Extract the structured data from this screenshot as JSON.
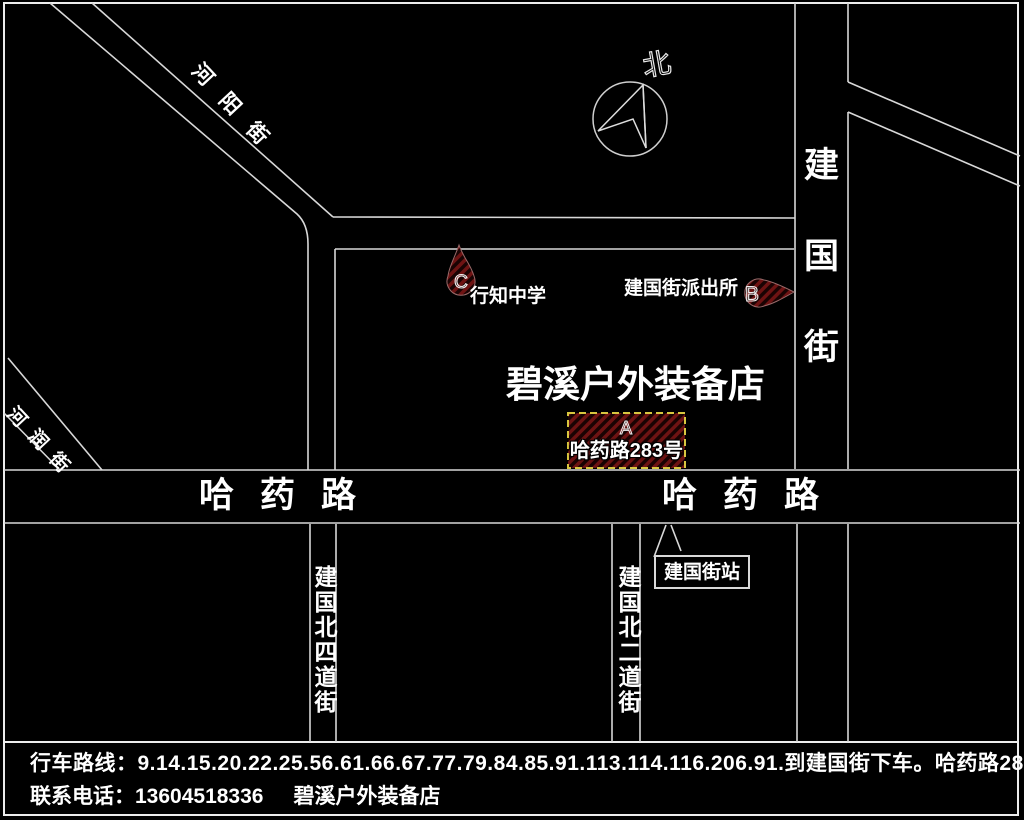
{
  "compass": {
    "north": "北"
  },
  "streets": {
    "heyang": "河阳街",
    "herun": "河润街",
    "jianguo_vertical": "建国街",
    "hayao_west": "哈药路",
    "hayao_east": "哈药路",
    "jianguo_north4": "建国北四道街",
    "jianguo_north2": "建国北二道街"
  },
  "markers": {
    "a": {
      "letter": "A",
      "address": "哈药路283号"
    },
    "b": {
      "letter": "B",
      "label": "建国街派出所"
    },
    "c": {
      "letter": "C",
      "label": "行知中学"
    }
  },
  "store": {
    "name": "碧溪户外装备店"
  },
  "bus_stop": {
    "label": "建国街站"
  },
  "footer": {
    "route": "行车路线：9.14.15.20.22.25.56.61.66.67.77.79.84.85.91.113.114.116.206.91.到建国街下车。哈药路283号。",
    "phone": "联系电话：13604518336",
    "store_name": "碧溪户外装备店"
  },
  "colors": {
    "background": "#000000",
    "road_line": "#d8d8d8",
    "marker_red": "#6e1313",
    "a_box_border": "#d8c63f",
    "text": "#ffffff"
  }
}
